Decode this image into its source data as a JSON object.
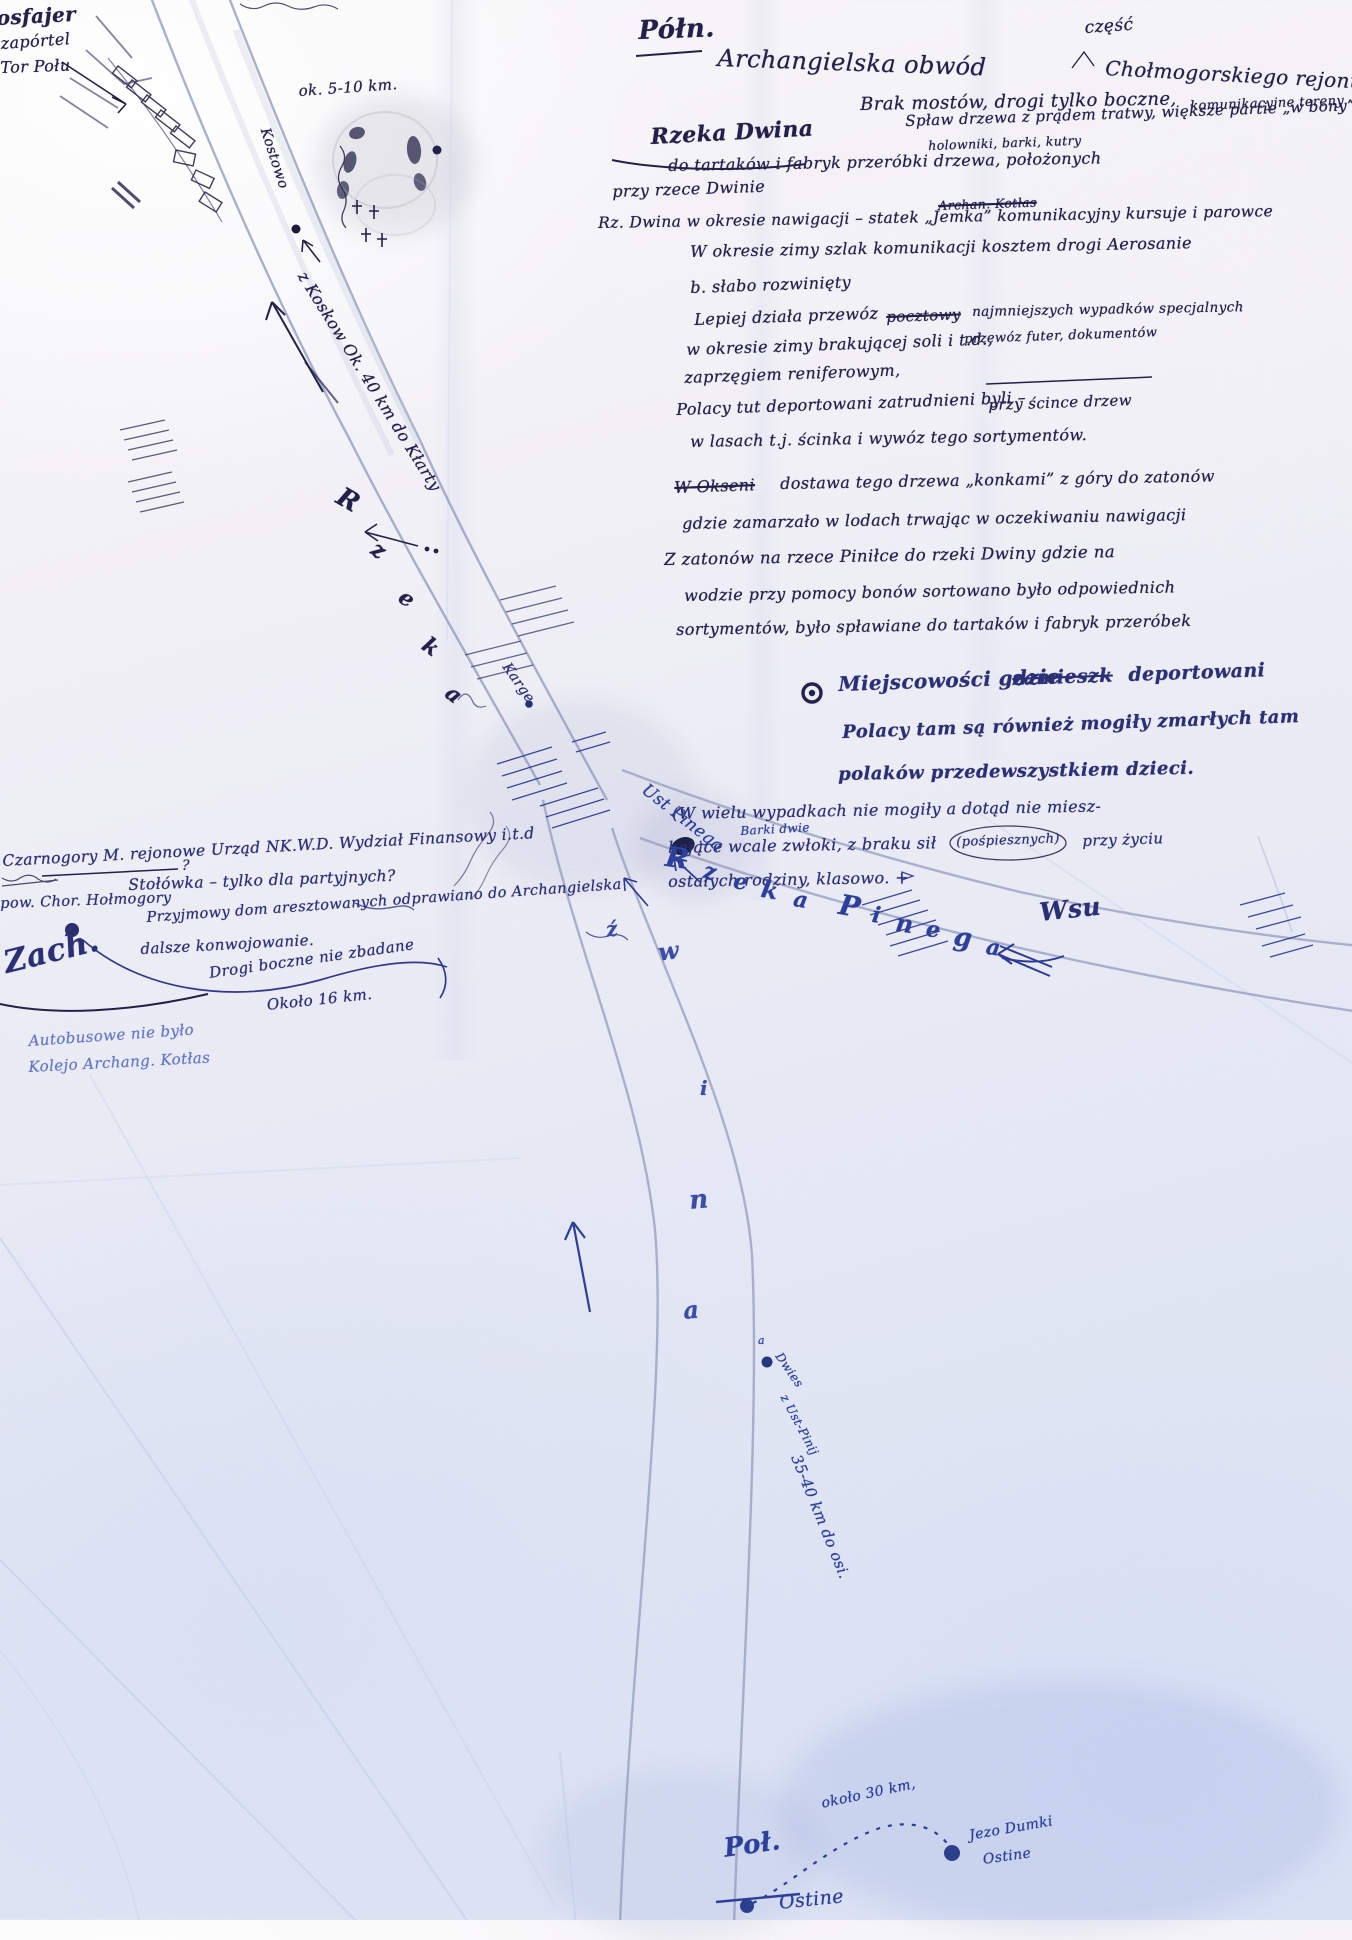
{
  "colors": {
    "ink_dark": "#23214a",
    "ink_mid": "#2b2f74",
    "ink_blue": "#2c3f9a",
    "pencil": "#8e97bc",
    "pencil_blue": "#6479c4"
  },
  "compass": {
    "north": "Półn.",
    "west": "Zach.",
    "south": "Poł."
  },
  "corner_note": {
    "l1": "osfajer",
    "l2": "zapórtel",
    "l3": "Tor Połu"
  },
  "header": {
    "part1": "Archangielska obwód",
    "insert": "część",
    "part2": "Chołmogorskiego rejonu"
  },
  "notes": {
    "r01a": "Brak mostów, drogi tylko boczne,",
    "r01b": "komunikacyjne tereny —",
    "r02": "Rzeka Dwina",
    "r03": "Spław drzewa z prądem tratwy, większe partie „w bony”",
    "r04": "holowniki, barki, kutry",
    "r05": "do tartaków i fabryk przeróbki drzewa, położonych",
    "r06": "przy rzece Dwinie",
    "r07a": "Rz. Dwina w okresie nawigacji – statek „Jemka” komunikacyjny kursuje i parowce",
    "r07b": "Archan. Kotłas",
    "r08": "W okresie zimy szlak komunikacji kosztem drogi Aerosanie",
    "r09": "b. słabo rozwinięty",
    "r10a": "Lepiej działa przewóz",
    "r10b": "pocztowy",
    "r10c": "najmniejszych wypadków specjalnych",
    "r11a": "w okresie zimy brakującej soli i t.d.,",
    "r11b": "przewóz futer, dokumentów",
    "r12": "zaprzęgiem reniferowym,",
    "r13a": "Polacy tut deportowani zatrudnieni byli –",
    "r13b": "przy ścince drzew",
    "r14": "w lasach t.j. ścinka i wywóz tego sortymentów.",
    "r15a": "W Okseni",
    "r15b": "dostawa tego drzewa „konkami” z góry do zatonów",
    "r16": "gdzie zamarzało w lodach trwając w oczekiwaniu nawigacji",
    "r17": "Z zatonów na rzece Piniłce do rzeki Dwiny gdzie na",
    "r18": "wodzie przy pomocy bonów sortowano było odpowiednich",
    "r19": "sortymentów, było spławiane do tartaków i fabryk przeróbek",
    "r20a": "Miejscowości gdzie",
    "r20b": "zamieszk",
    "r20c": "deportowani",
    "r21": "Polacy tam są również mogiły zmarłych tam",
    "r22": "polaków przedewszystkiem dzieci.",
    "r23": "(W wielu wypadkach nie mogiły a dotąd nie miesz-",
    "r24a": "kające wcale zwłoki, z braku sił",
    "r24b": "(pośpiesznych)",
    "r24c": "przy życiu",
    "r25": "ostałych rodziny, klasowo. +",
    "signature": "Wsu"
  },
  "left_notes": {
    "l1": "Czarnogory M. rejonowe Urząd NK.W.D. Wydział Finansowy i.t.d",
    "l2": "Stołówka – tylko dla partyjnych?",
    "q": "?",
    "l3": "pow. Chor. Hołmogory",
    "l4": "Przyjmowy dom aresztowanych odprawiano do Archangielska",
    "l5": "dalsze konwojowanie.",
    "l6": "Drogi boczne nie zbadane",
    "l7": "Około 16 km.",
    "blue1": "Autobusowe nie było",
    "blue2": "Kolejo Archang. Kotłas"
  },
  "map": {
    "dist_top": "ok. 5-10 km.",
    "kostowo": "Kostowo",
    "route_upper": "z Koskow Ok.  40 km  do Kłarty",
    "rzeka_letters": [
      "R",
      "z",
      "e",
      "k",
      "a"
    ],
    "karge": "Karge",
    "ust_pinega": "Ust Pinega",
    "fork_note": "Barki dwie",
    "pinega_letters": [
      "R",
      "z",
      "e",
      "k",
      "a",
      "P",
      "i",
      "n",
      "e",
      "g",
      "a"
    ],
    "dwina_letters": [
      "ź",
      "w",
      "i",
      "n",
      "a"
    ],
    "dot_mark": "a",
    "dot_note1": "Dwies",
    "dot_note2": "z Ust-Pinij",
    "route_south": "35-40 km do osi.",
    "dist_bottom": "około 30 km,",
    "ostine1": "Ostine",
    "jezo1": "Jezo Dumki",
    "jezo2": "Ostine"
  }
}
